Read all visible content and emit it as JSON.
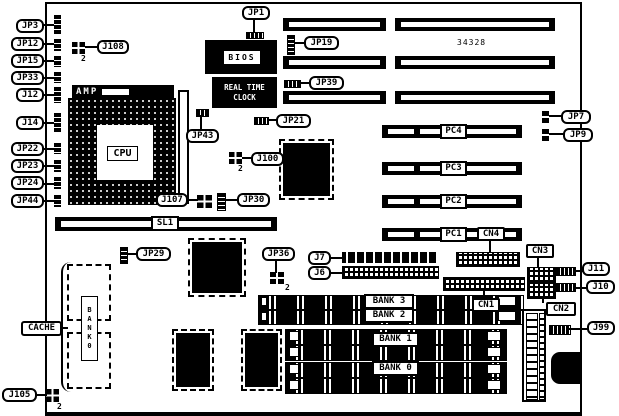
{
  "diagram": "motherboard-component-location",
  "colors": {
    "ink": "#000000",
    "paper": "#ffffff"
  },
  "annotations": {
    "part_number": "34328",
    "pin2": "2"
  },
  "chips": {
    "bios": "BIOS",
    "rtc_line1": "REAL TIME",
    "rtc_line2": "CLOCK",
    "amp": "AMP",
    "cpu": "CPU"
  },
  "callouts": {
    "jp3": "JP3",
    "jp12": "JP12",
    "jp15": "JP15",
    "jp33": "JP33",
    "j12": "J12",
    "j14": "J14",
    "jp22": "JP22",
    "jp23": "JP23",
    "jp24": "JP24",
    "jp44": "JP44",
    "j108": "J108",
    "jp1": "JP1",
    "jp19": "JP19",
    "jp39": "JP39",
    "jp21": "JP21",
    "jp43": "JP43",
    "j100": "J100",
    "j107": "J107",
    "jp30": "JP30",
    "jp7": "JP7",
    "jp9": "JP9",
    "jp29": "JP29",
    "jp36": "JP36",
    "j7": "J7",
    "j6": "J6",
    "cn4": "CN4",
    "cn3": "CN3",
    "cn1": "CN1",
    "cn2": "CN2",
    "j11": "J11",
    "j10": "J10",
    "j99": "J99",
    "cache": "CACHE",
    "j105": "J105"
  },
  "slots": {
    "sl1": "SL1",
    "pc4": "PC4",
    "pc3": "PC3",
    "pc2": "PC2",
    "pc1": "PC1"
  },
  "banks": {
    "bank3": "BANK 3",
    "bank2": "BANK 2",
    "bank1": "BANK 1",
    "bank0": "BANK 0",
    "cache_bank_vertical": "BANK0"
  }
}
